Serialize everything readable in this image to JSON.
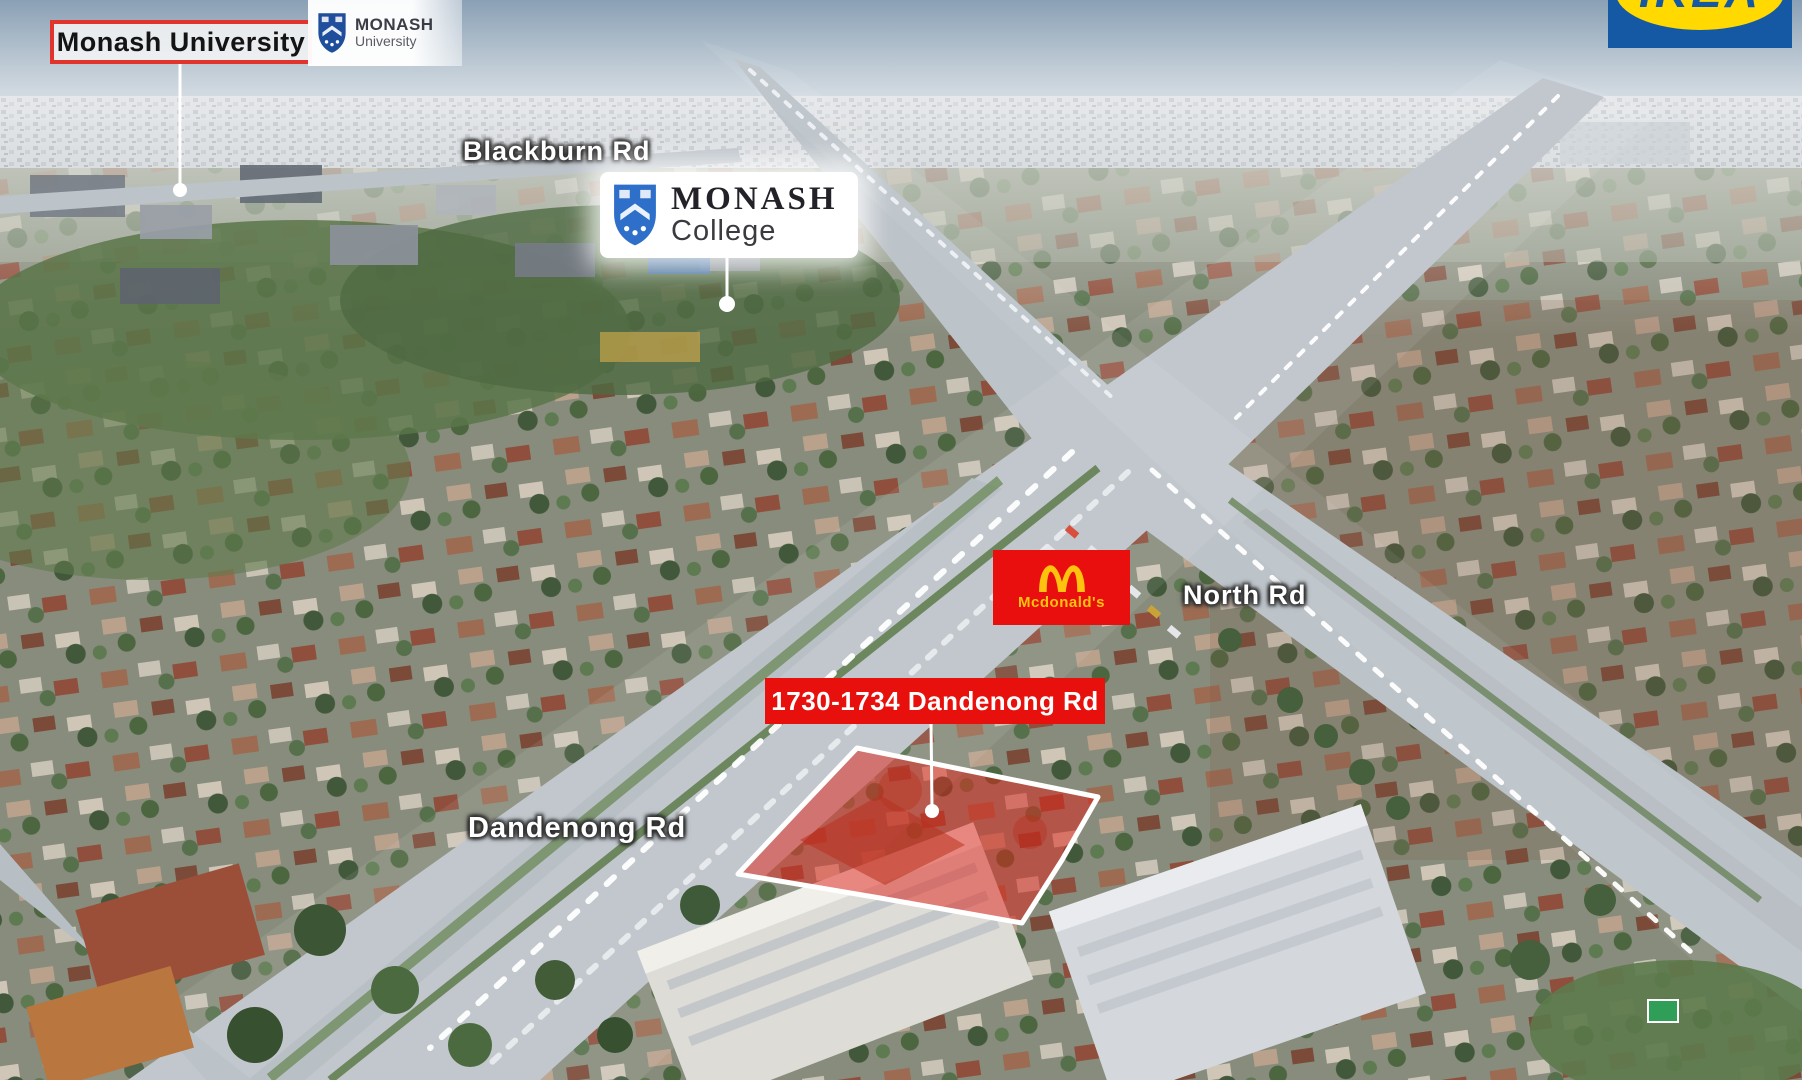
{
  "labels": {
    "monash_university_box": "Monash University",
    "blackburn_rd": "Blackburn Rd",
    "north_rd": "North Rd",
    "dandenong_rd": "Dandenong Rd",
    "property_address": "1730-1734 Dandenong Rd"
  },
  "logos": {
    "monash_university": {
      "line1": "MONASH",
      "line2": "University"
    },
    "monash_college": {
      "line1": "MONASH",
      "line2": "College"
    },
    "ikea": {
      "text": "IKEA"
    },
    "mcdonalds": {
      "text": "Mcdonald's"
    }
  },
  "colors": {
    "highlight_red": "#e8100c",
    "label_border_red": "#e0342c",
    "mcdonalds_red": "#e90f0f",
    "mcdonalds_yellow": "#ffc20e",
    "ikea_blue": "#1559a4",
    "ikea_yellow": "#ffd900",
    "monash_university_blue": "#1f4e9c",
    "monash_college_blue": "#2e6fc9",
    "property_overlay_red": "#e02016",
    "road_label_white": "#ffffff"
  }
}
